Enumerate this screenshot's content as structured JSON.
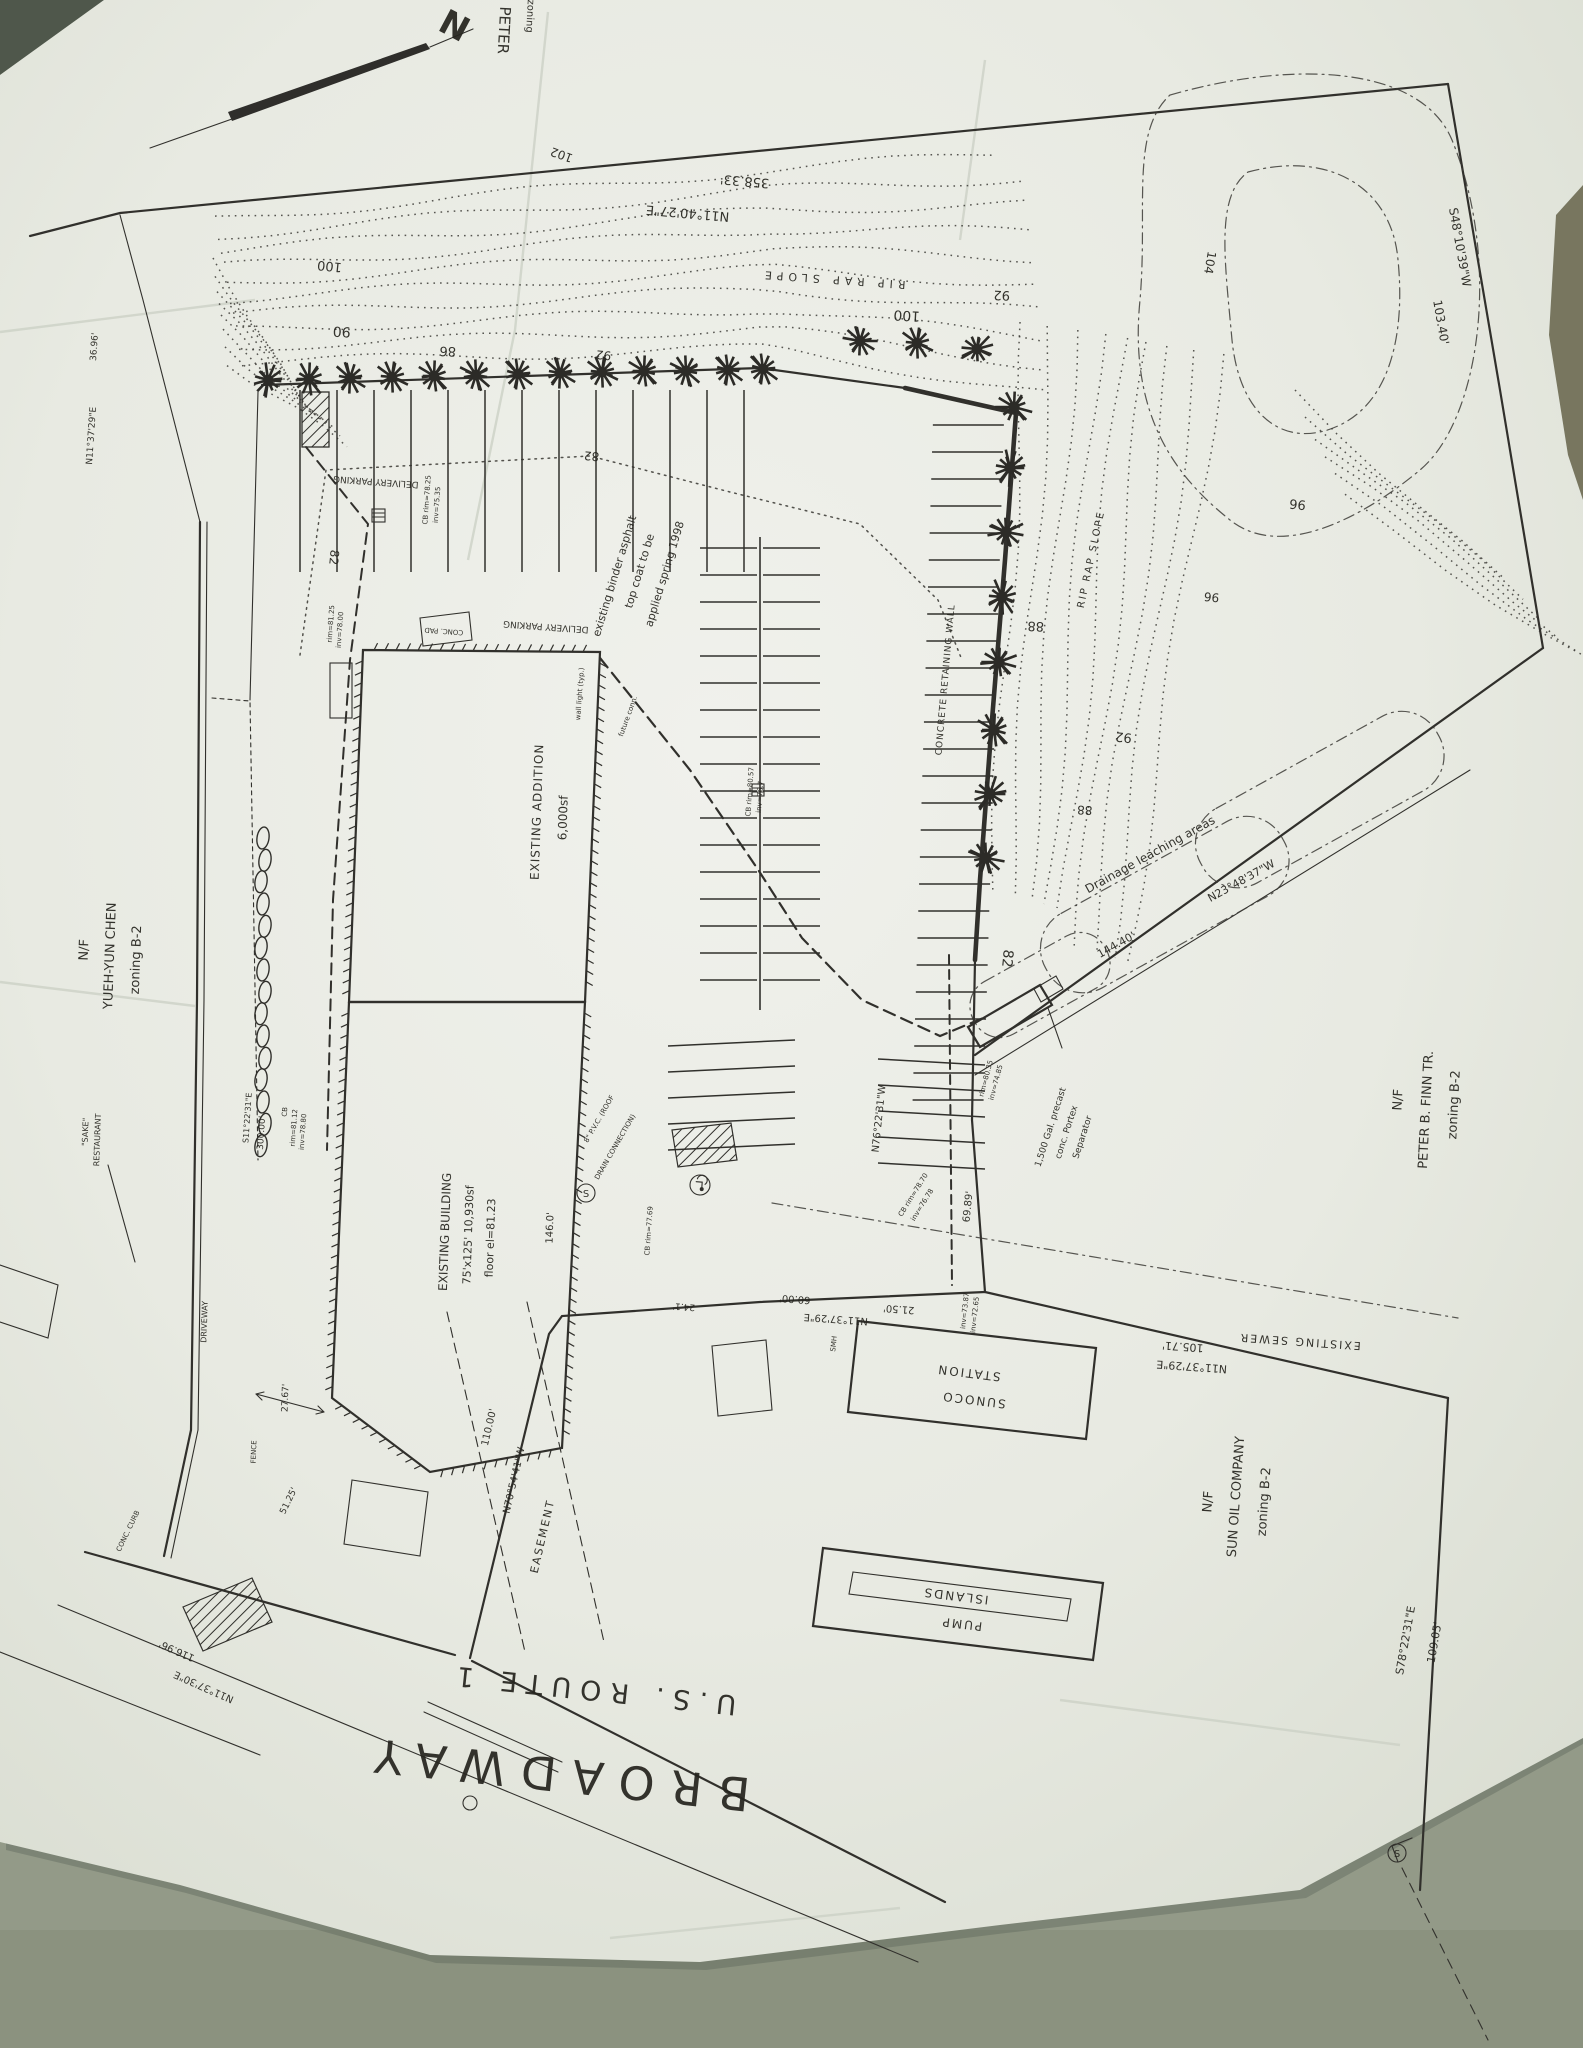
{
  "scan": {
    "background_color": "#939a88",
    "corner_shadow_color": "#4f574b",
    "right_sliver_color": "#8c8163",
    "paper_color": "#e9ebe4",
    "ink_color": "#2f2e2b"
  },
  "plan": {
    "road_name": "BROADWAY",
    "route_name": "U.S. ROUTE 1",
    "labels": [
      {
        "id": "cut-peter",
        "text": "PETER",
        "x": 499,
        "y": 30,
        "rot": 93,
        "fs": 15
      },
      {
        "id": "cut-zoning",
        "text": "zoning",
        "x": 527,
        "y": 16,
        "rot": 93,
        "fs": 10
      },
      {
        "id": "north-n",
        "text": "N",
        "x": 449,
        "y": 36,
        "rot": 28,
        "fs": 34,
        "bold": true
      },
      {
        "id": "brg-top",
        "text": "N11°40'27\"E",
        "x": 688,
        "y": 209,
        "rot": 185,
        "fs": 13
      },
      {
        "id": "dist-top",
        "text": "358.33'",
        "x": 745,
        "y": 177,
        "rot": 185,
        "fs": 13
      },
      {
        "id": "c102",
        "text": "102",
        "x": 563,
        "y": 151,
        "rot": 200,
        "fs": 12
      },
      {
        "id": "c100a",
        "text": "100",
        "x": 907,
        "y": 311,
        "rot": 183,
        "fs": 14
      },
      {
        "id": "c100b",
        "text": "100",
        "x": 330,
        "y": 262,
        "rot": 186,
        "fs": 13
      },
      {
        "id": "c90",
        "text": "90",
        "x": 342,
        "y": 327,
        "rot": 183,
        "fs": 14
      },
      {
        "id": "c86",
        "text": "86",
        "x": 448,
        "y": 347,
        "rot": 183,
        "fs": 13
      },
      {
        "id": "c92a",
        "text": "92",
        "x": 604,
        "y": 351,
        "rot": 186,
        "fs": 12
      },
      {
        "id": "c92b",
        "text": "92",
        "x": 1002,
        "y": 291,
        "rot": 183,
        "fs": 13
      },
      {
        "id": "c104",
        "text": "104",
        "x": 1206,
        "y": 262,
        "rot": 100,
        "fs": 12
      },
      {
        "id": "riprap-top",
        "text": "RIP RAP SLOPE",
        "x": 833,
        "y": 276,
        "rot": 184,
        "fs": 11,
        "ls": 5
      },
      {
        "id": "brg-ne",
        "text": "S48°10'39\"W",
        "x": 1456,
        "y": 248,
        "rot": 80,
        "fs": 12
      },
      {
        "id": "dist-ne",
        "text": "103.40'",
        "x": 1437,
        "y": 323,
        "rot": 80,
        "fs": 12
      },
      {
        "id": "c96a",
        "text": "96",
        "x": 1298,
        "y": 500,
        "rot": 186,
        "fs": 13
      },
      {
        "id": "c96b",
        "text": "96",
        "x": 1212,
        "y": 593,
        "rot": 186,
        "fs": 12
      },
      {
        "id": "c92c",
        "text": "92",
        "x": 1124,
        "y": 733,
        "rot": 186,
        "fs": 13
      },
      {
        "id": "c88a",
        "text": "88",
        "x": 1036,
        "y": 622,
        "rot": 183,
        "fs": 13
      },
      {
        "id": "c88b",
        "text": "88",
        "x": 1085,
        "y": 806,
        "rot": 183,
        "fs": 12
      },
      {
        "id": "riprap-wall",
        "text": "RIP RAP SLOPE",
        "x": 1094,
        "y": 560,
        "rot": -78,
        "fs": 10,
        "ls": 2
      },
      {
        "id": "retwall",
        "text": "CONCRETE RETAINING WALL",
        "x": 948,
        "y": 680,
        "rot": -85,
        "fs": 9,
        "ls": 1
      },
      {
        "id": "drainage",
        "text": "Drainage leaching areas",
        "x": 1152,
        "y": 858,
        "rot": -29,
        "fs": 12
      },
      {
        "id": "dist-se",
        "text": "144.40'",
        "x": 1118,
        "y": 948,
        "rot": -29,
        "fs": 11
      },
      {
        "id": "brg-se",
        "text": "N23°48'37\"W",
        "x": 1243,
        "y": 884,
        "rot": -29,
        "fs": 11
      },
      {
        "id": "c82a",
        "text": "82",
        "x": 592,
        "y": 452,
        "rot": 186,
        "fs": 12
      },
      {
        "id": "c82b",
        "text": "82",
        "x": 330,
        "y": 557,
        "rot": 96,
        "fs": 12
      },
      {
        "id": "c82c",
        "text": "82",
        "x": 1003,
        "y": 958,
        "rot": 96,
        "fs": 14
      },
      {
        "id": "binder1",
        "text": "existing binder asphalt",
        "x": 618,
        "y": 577,
        "rot": -73,
        "fs": 11
      },
      {
        "id": "binder2",
        "text": "top coat to be",
        "x": 643,
        "y": 572,
        "rot": -73,
        "fs": 11
      },
      {
        "id": "binder3",
        "text": "applied spring 1998",
        "x": 668,
        "y": 575,
        "rot": -73,
        "fs": 11
      },
      {
        "id": "delivery1",
        "text": "DELIVERY PARKING",
        "x": 376,
        "y": 479,
        "rot": 184,
        "fs": 9
      },
      {
        "id": "delivery2",
        "text": "DELIVERY PARKING",
        "x": 546,
        "y": 624,
        "rot": 184,
        "fs": 9
      },
      {
        "id": "concpad",
        "text": "CONC. PAD",
        "x": 444,
        "y": 629,
        "rot": 184,
        "fs": 7
      },
      {
        "id": "addition1",
        "text": "EXISTING ADDITION",
        "x": 541,
        "y": 812,
        "rot": -88,
        "fs": 12,
        "ls": 1
      },
      {
        "id": "addition2",
        "text": "6,000sf",
        "x": 567,
        "y": 818,
        "rot": -88,
        "fs": 12
      },
      {
        "id": "walllight",
        "text": "wall light (typ.)",
        "x": 582,
        "y": 694,
        "rot": -86,
        "fs": 7
      },
      {
        "id": "futconn",
        "text": "future conn.",
        "x": 630,
        "y": 717,
        "rot": -70,
        "fs": 7
      },
      {
        "id": "cb1a",
        "text": "CB rim=78.25",
        "x": 429,
        "y": 500,
        "rot": -86,
        "fs": 7
      },
      {
        "id": "cb1b",
        "text": "inv=75.35",
        "x": 439,
        "y": 505,
        "rot": -86,
        "fs": 7
      },
      {
        "id": "cb2a",
        "text": "CB rim=80.57",
        "x": 752,
        "y": 792,
        "rot": -86,
        "fs": 7
      },
      {
        "id": "cb2b",
        "text": "inv=76.7",
        "x": 762,
        "y": 797,
        "rot": -86,
        "fs": 7
      },
      {
        "id": "cb3a",
        "text": "CB rim=78.70",
        "x": 915,
        "y": 1196,
        "rot": -58,
        "fs": 7
      },
      {
        "id": "cb3b",
        "text": "inv=76.78",
        "x": 924,
        "y": 1206,
        "rot": -58,
        "fs": 7
      },
      {
        "id": "cb4",
        "text": "CB rim=77.69",
        "x": 651,
        "y": 1231,
        "rot": -86,
        "fs": 7
      },
      {
        "id": "cb5a",
        "text": "CB",
        "x": 287,
        "y": 1112,
        "rot": -86,
        "fs": 7
      },
      {
        "id": "cb5b",
        "text": "rim=81.12",
        "x": 296,
        "y": 1128,
        "rot": -86,
        "fs": 7
      },
      {
        "id": "cb5c",
        "text": "inv=78.80",
        "x": 305,
        "y": 1132,
        "rot": -86,
        "fs": 7
      },
      {
        "id": "cb6a",
        "text": "rim=81.25",
        "x": 333,
        "y": 624,
        "rot": -86,
        "fs": 7
      },
      {
        "id": "cb6b",
        "text": "inv=78.00",
        "x": 342,
        "y": 630,
        "rot": -86,
        "fs": 7
      },
      {
        "id": "sep1",
        "text": "1,500 Gal. precast",
        "x": 1053,
        "y": 1128,
        "rot": -72,
        "fs": 9
      },
      {
        "id": "sep2",
        "text": "conc. Portex",
        "x": 1069,
        "y": 1133,
        "rot": -72,
        "fs": 9
      },
      {
        "id": "sep3",
        "text": "Separator",
        "x": 1085,
        "y": 1138,
        "rot": -72,
        "fs": 9
      },
      {
        "id": "sep4",
        "text": "rim=80.35",
        "x": 988,
        "y": 1079,
        "rot": -75,
        "fs": 7
      },
      {
        "id": "sep5",
        "text": "inv=74.85",
        "x": 998,
        "y": 1083,
        "rot": -75,
        "fs": 7
      },
      {
        "id": "brg-e",
        "text": "N76°22'31\"W",
        "x": 882,
        "y": 1119,
        "rot": -84,
        "fs": 10
      },
      {
        "id": "dist-e",
        "text": "69.89'",
        "x": 971,
        "y": 1207,
        "rot": -84,
        "fs": 10
      },
      {
        "id": "inv1",
        "text": "inv=73.87",
        "x": 967,
        "y": 1311,
        "rot": -84,
        "fs": 7
      },
      {
        "id": "inv2",
        "text": "inv=72.65",
        "x": 977,
        "y": 1315,
        "rot": -84,
        "fs": 7
      },
      {
        "id": "smh",
        "text": "SMH",
        "x": 836,
        "y": 1344,
        "rot": -84,
        "fs": 7
      },
      {
        "id": "b6000",
        "text": "60.00'",
        "x": 795,
        "y": 1296,
        "rot": 184,
        "fs": 10
      },
      {
        "id": "b2150",
        "text": "21.50'",
        "x": 899,
        "y": 1306,
        "rot": 184,
        "fs": 10
      },
      {
        "id": "brg-s",
        "text": "N11°37'29\"E",
        "x": 836,
        "y": 1316,
        "rot": 184,
        "fs": 10
      },
      {
        "id": "b241",
        "text": "24.1'",
        "x": 684,
        "y": 1304,
        "rot": 184,
        "fs": 9
      },
      {
        "id": "sewer-lbl",
        "text": "EXISTING SEWER",
        "x": 1300,
        "y": 1338,
        "rot": 184,
        "fs": 11,
        "ls": 2
      },
      {
        "id": "d10571",
        "text": "105.71'",
        "x": 1183,
        "y": 1343,
        "rot": 184,
        "fs": 11
      },
      {
        "id": "brg-s2",
        "text": "N11°37'29\"E",
        "x": 1192,
        "y": 1363,
        "rot": 184,
        "fs": 11
      },
      {
        "id": "finn1",
        "text": "N/F",
        "x": 1402,
        "y": 1100,
        "rot": -87,
        "fs": 13
      },
      {
        "id": "finn2",
        "text": "PETER B. FINN TR.",
        "x": 1430,
        "y": 1110,
        "rot": -87,
        "fs": 13
      },
      {
        "id": "finn3",
        "text": "zoning B-2",
        "x": 1458,
        "y": 1105,
        "rot": -87,
        "fs": 13
      },
      {
        "id": "sunoco1",
        "text": "SUNOCO",
        "x": 974,
        "y": 1396,
        "rot": 187,
        "fs": 12,
        "ls": 2
      },
      {
        "id": "sunoco2",
        "text": "STATION",
        "x": 969,
        "y": 1369,
        "rot": 187,
        "fs": 12,
        "ls": 2
      },
      {
        "id": "pump1",
        "text": "PUMP",
        "x": 962,
        "y": 1620,
        "rot": 187,
        "fs": 12,
        "ls": 2
      },
      {
        "id": "pump2",
        "text": "ISLANDS",
        "x": 956,
        "y": 1592,
        "rot": 187,
        "fs": 12,
        "ls": 2
      },
      {
        "id": "sun1",
        "text": "N/F",
        "x": 1212,
        "y": 1502,
        "rot": -86,
        "fs": 13
      },
      {
        "id": "sun2",
        "text": "SUN OIL COMPANY",
        "x": 1240,
        "y": 1497,
        "rot": -86,
        "fs": 13
      },
      {
        "id": "sun3",
        "text": "zoning B-2",
        "x": 1268,
        "y": 1502,
        "rot": -86,
        "fs": 13
      },
      {
        "id": "brg-sun",
        "text": "S78°22'31\"E",
        "x": 1409,
        "y": 1641,
        "rot": -80,
        "fs": 11
      },
      {
        "id": "dist-sun",
        "text": "109.05'",
        "x": 1438,
        "y": 1643,
        "rot": -80,
        "fs": 11
      },
      {
        "id": "chen1",
        "text": "N/F",
        "x": 88,
        "y": 950,
        "rot": -88,
        "fs": 13
      },
      {
        "id": "chen2",
        "text": "YUEH-YUN CHEN",
        "x": 114,
        "y": 956,
        "rot": -88,
        "fs": 13
      },
      {
        "id": "chen3",
        "text": "zoning B-2",
        "x": 140,
        "y": 960,
        "rot": -88,
        "fs": 13
      },
      {
        "id": "sake1",
        "text": "\"SAKE\"",
        "x": 88,
        "y": 1132,
        "rot": -88,
        "fs": 8
      },
      {
        "id": "sake2",
        "text": "RESTAURANT",
        "x": 100,
        "y": 1140,
        "rot": -88,
        "fs": 8
      },
      {
        "id": "brg-w",
        "text": "S11°22'31\"E",
        "x": 250,
        "y": 1118,
        "rot": -86,
        "fs": 8
      },
      {
        "id": "d30000",
        "text": "300.00'",
        "x": 264,
        "y": 1133,
        "rot": -86,
        "fs": 9
      },
      {
        "id": "bldg1",
        "text": "EXISTING BUILDING",
        "x": 449,
        "y": 1232,
        "rot": -88,
        "fs": 12
      },
      {
        "id": "bldg2",
        "text": "75'x125'  10,930sf",
        "x": 472,
        "y": 1235,
        "rot": -88,
        "fs": 11
      },
      {
        "id": "bldg3",
        "text": "floor el=81.23",
        "x": 494,
        "y": 1238,
        "rot": -88,
        "fs": 11
      },
      {
        "id": "d1460",
        "text": "146.0'",
        "x": 553,
        "y": 1228,
        "rot": -88,
        "fs": 10
      },
      {
        "id": "pvc1",
        "text": "8\" P.V.C. (ROOF",
        "x": 601,
        "y": 1120,
        "rot": -60,
        "fs": 7
      },
      {
        "id": "pvc2",
        "text": "DRAIN CONNECTION)",
        "x": 617,
        "y": 1148,
        "rot": -60,
        "fs": 7
      },
      {
        "id": "d2767",
        "text": "27.67'",
        "x": 288,
        "y": 1398,
        "rot": -88,
        "fs": 9
      },
      {
        "id": "fence",
        "text": "FENCE",
        "x": 256,
        "y": 1452,
        "rot": -88,
        "fs": 7
      },
      {
        "id": "d11696",
        "text": "116.96'",
        "x": 178,
        "y": 1648,
        "rot": 204,
        "fs": 10
      },
      {
        "id": "brg-bw",
        "text": "N11°37'30\"E",
        "x": 205,
        "y": 1684,
        "rot": 204,
        "fs": 10
      },
      {
        "id": "ease1",
        "text": "110.00'",
        "x": 492,
        "y": 1428,
        "rot": -77,
        "fs": 10
      },
      {
        "id": "ease2",
        "text": "N70°54'41\"W",
        "x": 517,
        "y": 1481,
        "rot": -77,
        "fs": 10
      },
      {
        "id": "ease3",
        "text": "EASEMENT",
        "x": 546,
        "y": 1537,
        "rot": -77,
        "fs": 11,
        "ls": 2
      },
      {
        "id": "d5125",
        "text": "51.25'",
        "x": 291,
        "y": 1502,
        "rot": -64,
        "fs": 9
      },
      {
        "id": "driveway",
        "text": "DRIVEWAY",
        "x": 207,
        "y": 1322,
        "rot": -88,
        "fs": 8
      },
      {
        "id": "conccurb",
        "text": "CONC. CURB",
        "x": 130,
        "y": 1532,
        "rot": -64,
        "fs": 7
      },
      {
        "id": "broadway",
        "text": "BROADWAY",
        "x": 556,
        "y": 1758,
        "rot": 186,
        "fs": 46,
        "ls": 16
      },
      {
        "id": "usroute",
        "text": "U.S. ROUTE 1",
        "x": 593,
        "y": 1681,
        "rot": 186,
        "fs": 27,
        "ls": 9
      },
      {
        "id": "brg-wn",
        "text": "N11°37'29\"E",
        "x": 94,
        "y": 436,
        "rot": -86,
        "fs": 9
      },
      {
        "id": "d3696",
        "text": "36.96'",
        "x": 97,
        "y": 347,
        "rot": -86,
        "fs": 9
      },
      {
        "id": "smanhole1",
        "text": "S",
        "x": 586,
        "y": 1197,
        "rot": 0,
        "fs": 10
      },
      {
        "id": "smanhole2",
        "text": "S",
        "x": 1397,
        "y": 1857,
        "rot": 0,
        "fs": 10
      }
    ],
    "contour_values_shown": [
      82,
      86,
      88,
      90,
      92,
      96,
      100,
      102,
      104
    ],
    "trees": {
      "top_row": [
        [
          268,
          380
        ],
        [
          309,
          379
        ],
        [
          350,
          378
        ],
        [
          392,
          377
        ],
        [
          434,
          376
        ],
        [
          476,
          375
        ],
        [
          518,
          374
        ],
        [
          560,
          373
        ],
        [
          602,
          372
        ],
        [
          644,
          371
        ],
        [
          686,
          371
        ],
        [
          728,
          370
        ],
        [
          763,
          369
        ],
        [
          860,
          341
        ],
        [
          917,
          343
        ],
        [
          977,
          349
        ]
      ],
      "wall_row": [
        [
          1014,
          407
        ],
        [
          1010,
          468
        ],
        [
          1006,
          532
        ],
        [
          1002,
          597
        ],
        [
          999,
          662
        ],
        [
          994,
          730
        ],
        [
          990,
          794
        ],
        [
          986,
          858
        ]
      ]
    },
    "bushes": {
      "x": 263,
      "y_start": 838,
      "y_end": 1158,
      "step": 22
    },
    "symbols": {
      "sewer_manholes": [
        [
          586,
          1193
        ],
        [
          1397,
          1853
        ]
      ],
      "handicap_space": [
        700,
        1185
      ],
      "catch_basin_boxes": [
        [
          378,
          515
        ],
        [
          758,
          790
        ],
        [
          586,
          1193
        ]
      ]
    }
  }
}
